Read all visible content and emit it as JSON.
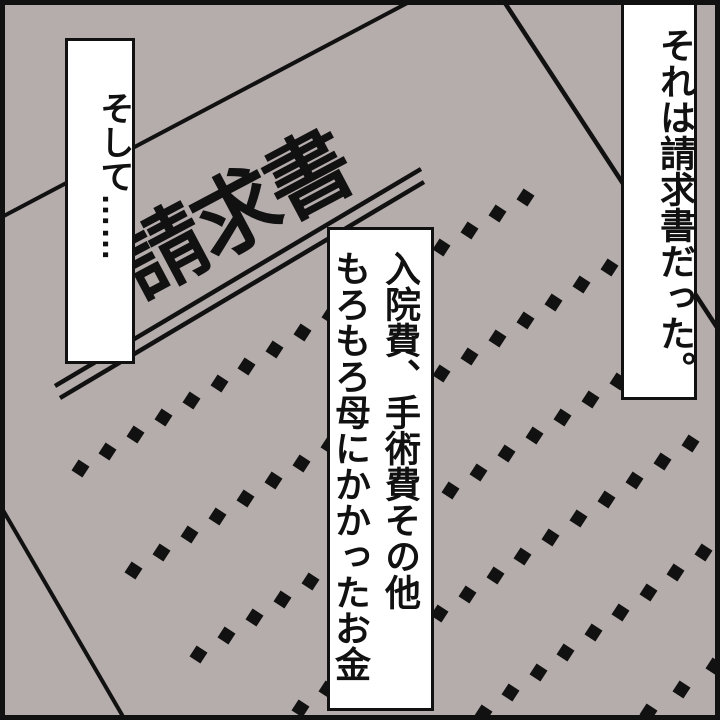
{
  "panel": {
    "background_color": "#b5adac",
    "ink_color": "#111111",
    "caption_right": "それは請求書だった。",
    "caption_left": "そして……",
    "caption_middle": {
      "line1": "入院費、手術費その他",
      "line2": "もろもろ母にかかったお金"
    },
    "paper_title": "請求書"
  }
}
